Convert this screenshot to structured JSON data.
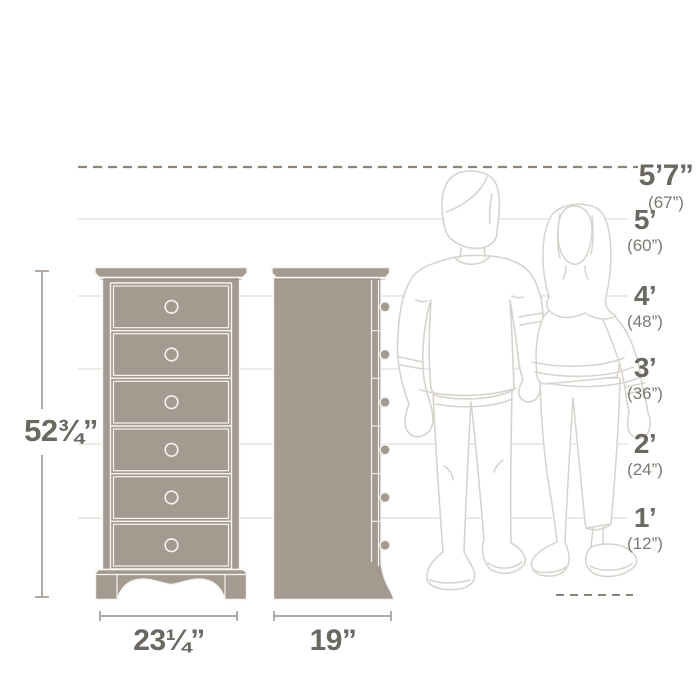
{
  "dimension_labels": {
    "height": "52¾”",
    "width": "23¼”",
    "depth": "19”"
  },
  "height_scale": [
    {
      "main": "5’7”",
      "sub": "(67”)"
    },
    {
      "main": "5’",
      "sub": "(60”)"
    },
    {
      "main": "4’",
      "sub": "(48”)"
    },
    {
      "main": "3’",
      "sub": "(36”)"
    },
    {
      "main": "2’",
      "sub": "(24”)"
    },
    {
      "main": "1’",
      "sub": "(12”)"
    }
  ],
  "views": {
    "front_drawer_count": 6,
    "side_knob_count": 6
  },
  "colors": {
    "furniture_fill": "#a49a90",
    "furniture_outline": "#f7f5f2",
    "dimension_lines": "#9a9086",
    "dashed_lines": "#8d8479",
    "grid_lines": "#e7e4e0",
    "figure_outline": "#d7d3cc",
    "label_text": "#6b6862",
    "sub_label_text": "#7d7972"
  }
}
